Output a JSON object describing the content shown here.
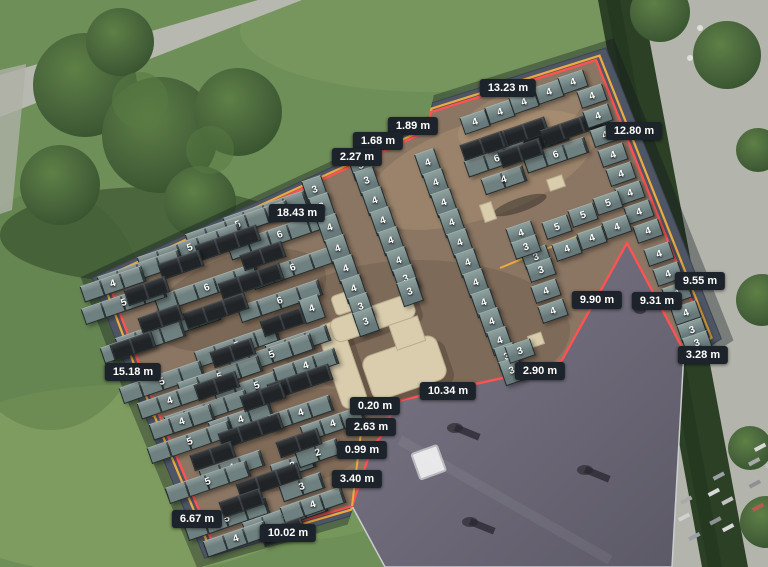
{
  "canvas": {
    "width": 768,
    "height": 567
  },
  "colors": {
    "boundary_red": "#ff5252",
    "boundary_yellow": "#ecab3f",
    "label_bg": "#1d232b",
    "label_text": "#ffffff",
    "panel_teal": "#6e807f",
    "panel_black": "#212427",
    "roof": "#8b7663"
  },
  "measurements": [
    {
      "label": "13.23 m",
      "x": 508,
      "y": 88
    },
    {
      "label": "1.89 m",
      "x": 413,
      "y": 126
    },
    {
      "label": "1.68 m",
      "x": 378,
      "y": 141
    },
    {
      "label": "2.27 m",
      "x": 357,
      "y": 157
    },
    {
      "label": "18.43 m",
      "x": 297,
      "y": 213
    },
    {
      "label": "12.80 m",
      "x": 634,
      "y": 131
    },
    {
      "label": "9.55 m",
      "x": 700,
      "y": 281
    },
    {
      "label": "9.90 m",
      "x": 597,
      "y": 300
    },
    {
      "label": "9.31 m",
      "x": 657,
      "y": 301
    },
    {
      "label": "3.28 m",
      "x": 703,
      "y": 355
    },
    {
      "label": "2.90 m",
      "x": 540,
      "y": 371
    },
    {
      "label": "10.34 m",
      "x": 448,
      "y": 391
    },
    {
      "label": "0.20 m",
      "x": 375,
      "y": 406
    },
    {
      "label": "2.63 m",
      "x": 371,
      "y": 427
    },
    {
      "label": "0.99 m",
      "x": 362,
      "y": 450
    },
    {
      "label": "3.40 m",
      "x": 357,
      "y": 479
    },
    {
      "label": "15.18 m",
      "x": 133,
      "y": 372
    },
    {
      "label": "6.67 m",
      "x": 197,
      "y": 519
    },
    {
      "label": "10.02 m",
      "x": 288,
      "y": 533
    }
  ],
  "panel_rows": [
    [
      266,
      212,
      4,
      "4",
      "t"
    ],
    [
      238,
      225,
      5,
      "5",
      "t"
    ],
    [
      280,
      235,
      5,
      "6",
      "t"
    ],
    [
      190,
      248,
      5,
      "5",
      "t"
    ],
    [
      293,
      268,
      4,
      "6",
      "t"
    ],
    [
      140,
      271,
      4,
      "5",
      "t"
    ],
    [
      113,
      284,
      3,
      "4",
      "t"
    ],
    [
      207,
      288,
      5,
      "6",
      "t"
    ],
    [
      124,
      303,
      4,
      "5",
      "t"
    ],
    [
      280,
      301,
      4,
      "6",
      "t"
    ],
    [
      168,
      329,
      5,
      "6",
      "t"
    ],
    [
      143,
      342,
      4,
      "5",
      "t"
    ],
    [
      237,
      346,
      4,
      "5",
      "t"
    ],
    [
      298,
      343,
      3,
      "4",
      "t"
    ],
    [
      272,
      355,
      4,
      "5",
      "t"
    ],
    [
      162,
      382,
      4,
      "5",
      "t"
    ],
    [
      220,
      377,
      4,
      "5",
      "t"
    ],
    [
      257,
      386,
      4,
      "5",
      "t"
    ],
    [
      306,
      366,
      3,
      "4",
      "t"
    ],
    [
      170,
      401,
      3,
      "4",
      "t"
    ],
    [
      207,
      411,
      4,
      "5",
      "t"
    ],
    [
      182,
      422,
      3,
      "4",
      "t"
    ],
    [
      241,
      420,
      3,
      "4",
      "t"
    ],
    [
      301,
      413,
      3,
      "4",
      "t"
    ],
    [
      333,
      424,
      3,
      "4",
      "t"
    ],
    [
      190,
      442,
      4,
      "5",
      "t"
    ],
    [
      232,
      468,
      3,
      "4",
      "t"
    ],
    [
      293,
      466,
      2,
      "3",
      "t"
    ],
    [
      318,
      453,
      2,
      "2",
      "t"
    ],
    [
      208,
      482,
      4,
      "5",
      "t"
    ],
    [
      302,
      487,
      2,
      "3",
      "t"
    ],
    [
      227,
      519,
      4,
      "5",
      "t"
    ],
    [
      285,
      517,
      4,
      "5",
      "t"
    ],
    [
      313,
      505,
      3,
      "4",
      "t"
    ],
    [
      236,
      539,
      3,
      "4",
      "t"
    ],
    [
      497,
      159,
      3,
      "6",
      "t"
    ],
    [
      556,
      155,
      3,
      "6",
      "t"
    ],
    [
      504,
      180,
      2,
      "4",
      "t"
    ],
    [
      546,
      139,
      2,
      "2",
      "k"
    ],
    [
      228,
      243,
      3,
      "",
      "k"
    ],
    [
      263,
      256,
      2,
      "",
      "k"
    ],
    [
      181,
      265,
      2,
      "",
      "k"
    ],
    [
      147,
      291,
      2,
      "",
      "k"
    ],
    [
      251,
      281,
      3,
      "",
      "k"
    ],
    [
      216,
      311,
      3,
      "",
      "k"
    ],
    [
      161,
      319,
      2,
      "",
      "k"
    ],
    [
      133,
      346,
      2,
      "",
      "k"
    ],
    [
      283,
      322,
      2,
      "",
      "k"
    ],
    [
      233,
      353,
      2,
      "",
      "k"
    ],
    [
      217,
      386,
      2,
      "",
      "k"
    ],
    [
      300,
      382,
      3,
      "",
      "k"
    ],
    [
      263,
      397,
      2,
      "",
      "k"
    ],
    [
      251,
      431,
      3,
      "",
      "k"
    ],
    [
      299,
      443,
      2,
      "",
      "k"
    ],
    [
      213,
      456,
      2,
      "",
      "k"
    ],
    [
      269,
      481,
      3,
      "",
      "k"
    ],
    [
      242,
      503,
      2,
      "",
      "k"
    ],
    [
      283,
      532,
      2,
      "",
      "k"
    ],
    [
      516,
      135,
      3,
      "",
      "k"
    ],
    [
      573,
      128,
      3,
      "",
      "k"
    ],
    [
      483,
      146,
      2,
      "",
      "k"
    ],
    [
      521,
      153,
      2,
      "",
      "k"
    ]
  ],
  "panel_cells": [
    [
      475,
      122,
      "4",
      "l"
    ],
    [
      500,
      112,
      "4",
      "l"
    ],
    [
      524,
      102,
      "4",
      "l"
    ],
    [
      549,
      92,
      "4",
      "l"
    ],
    [
      573,
      82,
      "4",
      "l"
    ],
    [
      592,
      96,
      "4",
      "l"
    ],
    [
      598,
      116,
      "4",
      "l"
    ],
    [
      605,
      135,
      "4",
      "l"
    ],
    [
      613,
      155,
      "4",
      "l"
    ],
    [
      621,
      174,
      "4",
      "l"
    ],
    [
      630,
      193,
      "4",
      "l"
    ],
    [
      639,
      212,
      "4",
      "l"
    ],
    [
      648,
      231,
      "4",
      "l"
    ],
    [
      659,
      254,
      "4",
      "l"
    ],
    [
      668,
      274,
      "4",
      "l"
    ],
    [
      677,
      293,
      "4",
      "l"
    ],
    [
      686,
      313,
      "4",
      "l"
    ],
    [
      692,
      330,
      "3",
      "l"
    ],
    [
      697,
      343,
      "3",
      "l"
    ],
    [
      315,
      190,
      "3",
      "p"
    ],
    [
      322,
      207,
      "3",
      "p"
    ],
    [
      330,
      228,
      "4",
      "p"
    ],
    [
      338,
      249,
      "4",
      "p"
    ],
    [
      346,
      269,
      "4",
      "p"
    ],
    [
      354,
      289,
      "4",
      "p"
    ],
    [
      361,
      307,
      "3",
      "p"
    ],
    [
      366,
      322,
      "3",
      "p"
    ],
    [
      361,
      166,
      "3",
      "p"
    ],
    [
      367,
      181,
      "3",
      "p"
    ],
    [
      375,
      201,
      "4",
      "p"
    ],
    [
      383,
      221,
      "4",
      "p"
    ],
    [
      391,
      241,
      "4",
      "p"
    ],
    [
      399,
      261,
      "4",
      "p"
    ],
    [
      406,
      279,
      "3",
      "p"
    ],
    [
      410,
      292,
      "3",
      "p"
    ],
    [
      428,
      163,
      "4",
      "p"
    ],
    [
      436,
      183,
      "4",
      "p"
    ],
    [
      444,
      203,
      "4",
      "p"
    ],
    [
      452,
      223,
      "4",
      "p"
    ],
    [
      460,
      243,
      "4",
      "p"
    ],
    [
      468,
      263,
      "4",
      "p"
    ],
    [
      476,
      283,
      "4",
      "p"
    ],
    [
      484,
      303,
      "4",
      "p"
    ],
    [
      492,
      322,
      "4",
      "p"
    ],
    [
      500,
      341,
      "4",
      "p"
    ],
    [
      507,
      357,
      "3",
      "p"
    ],
    [
      512,
      371,
      "3",
      "p"
    ],
    [
      557,
      227,
      "5",
      "l"
    ],
    [
      583,
      215,
      "5",
      "l"
    ],
    [
      608,
      203,
      "5",
      "l"
    ],
    [
      567,
      249,
      "4",
      "l"
    ],
    [
      592,
      238,
      "4",
      "l"
    ],
    [
      617,
      227,
      "4",
      "l"
    ],
    [
      536,
      257,
      "3",
      "l"
    ],
    [
      541,
      270,
      "3",
      "l"
    ],
    [
      521,
      233,
      "4",
      "l"
    ],
    [
      526,
      247,
      "3",
      "l"
    ],
    [
      546,
      291,
      "4",
      "l"
    ],
    [
      553,
      311,
      "4",
      "l"
    ],
    [
      520,
      351,
      "3",
      "l"
    ],
    [
      312,
      309,
      "4",
      "p"
    ]
  ]
}
